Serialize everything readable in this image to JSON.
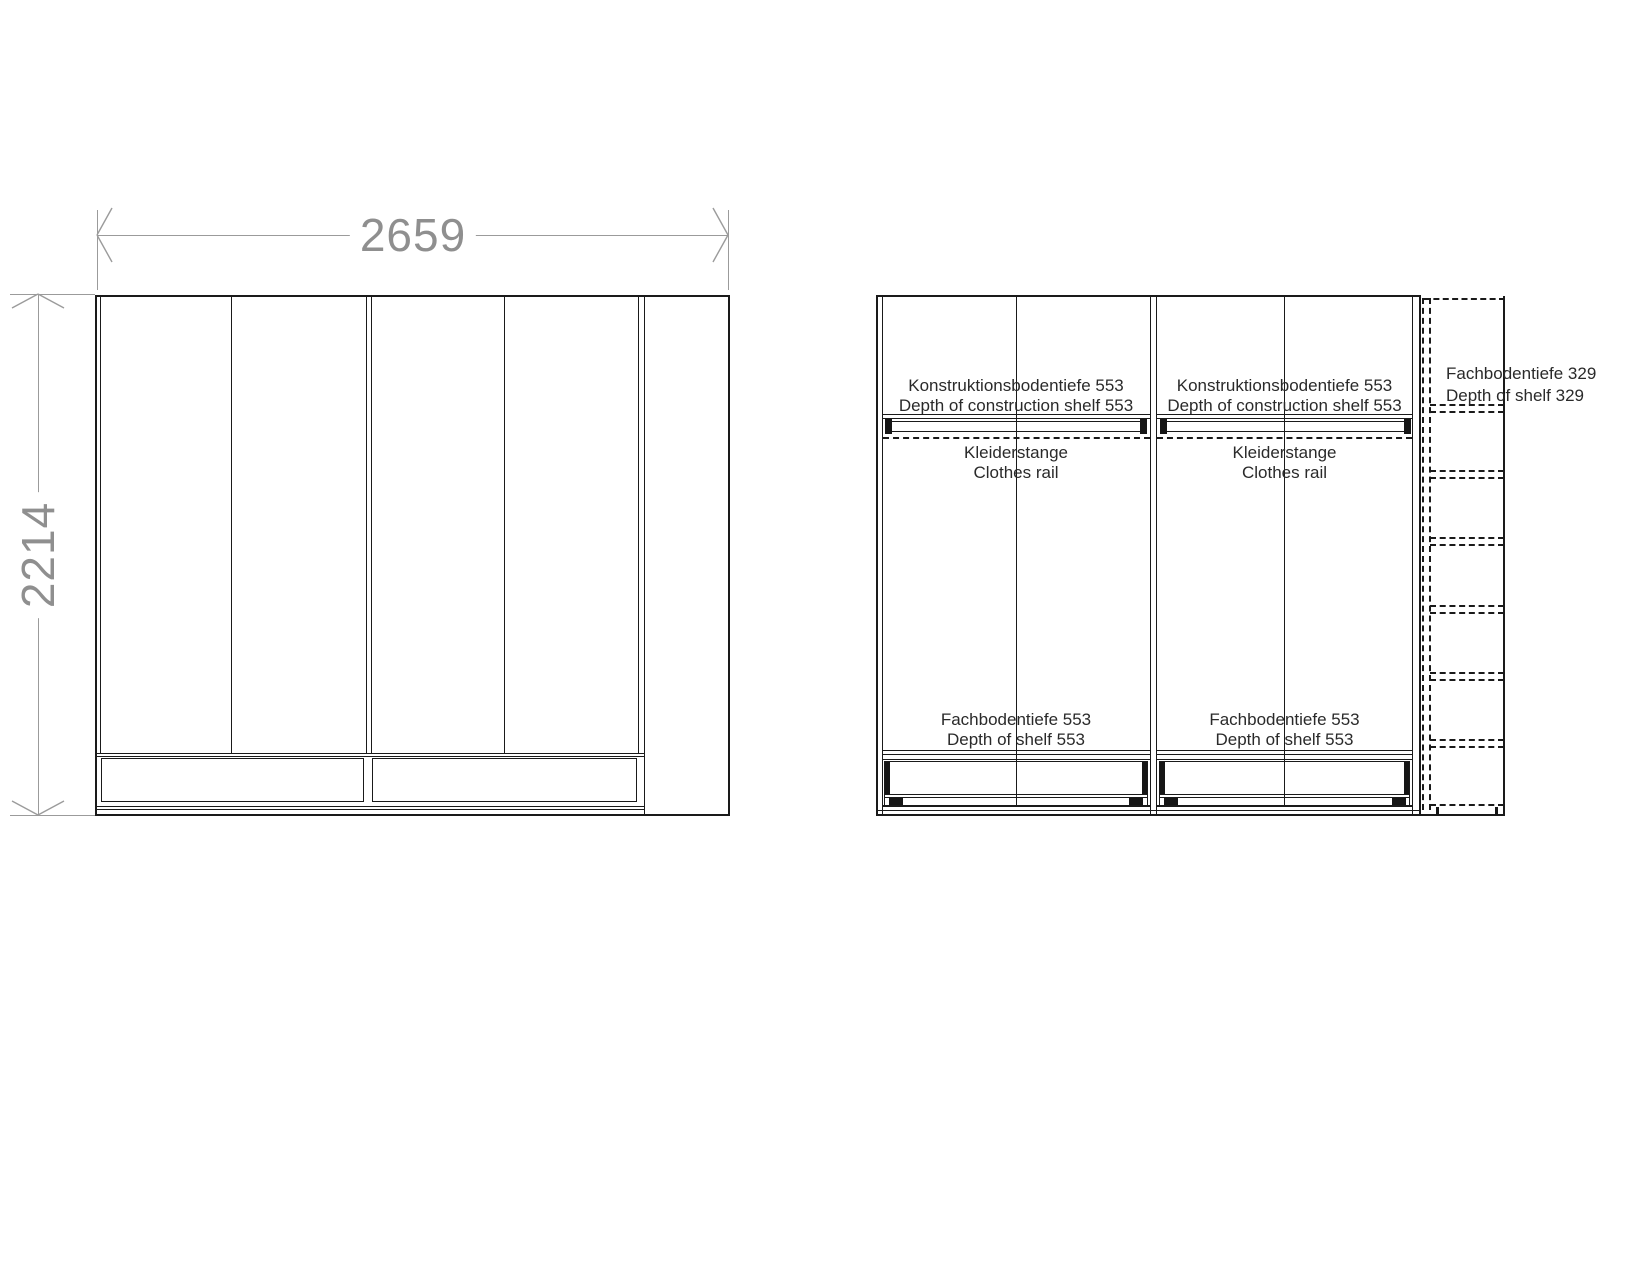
{
  "front_view": {
    "width_label": "2659",
    "height_label": "2214"
  },
  "interior_view": {
    "sections": [
      {
        "construction_shelf_de": "Konstruktionsbodentiefe 553",
        "construction_shelf_en": "Depth of construction shelf 553",
        "rail_de": "Kleiderstange",
        "rail_en": "Clothes rail",
        "shelf_de": "Fachbodentiefe 553",
        "shelf_en": "Depth of shelf 553"
      },
      {
        "construction_shelf_de": "Konstruktionsbodentiefe 553",
        "construction_shelf_en": "Depth of construction shelf 553",
        "rail_de": "Kleiderstange",
        "rail_en": "Clothes rail",
        "shelf_de": "Fachbodentiefe 553",
        "shelf_en": "Depth of shelf 553"
      }
    ],
    "side_column": {
      "shelf_de": "Fachbodentiefe 329",
      "shelf_en": "Depth of shelf 329"
    }
  },
  "colors": {
    "line": "#1a1a1a",
    "dimension": "#9b9b9b",
    "dimension_text": "#8f8f8f",
    "label_text": "#2a2a2a"
  }
}
